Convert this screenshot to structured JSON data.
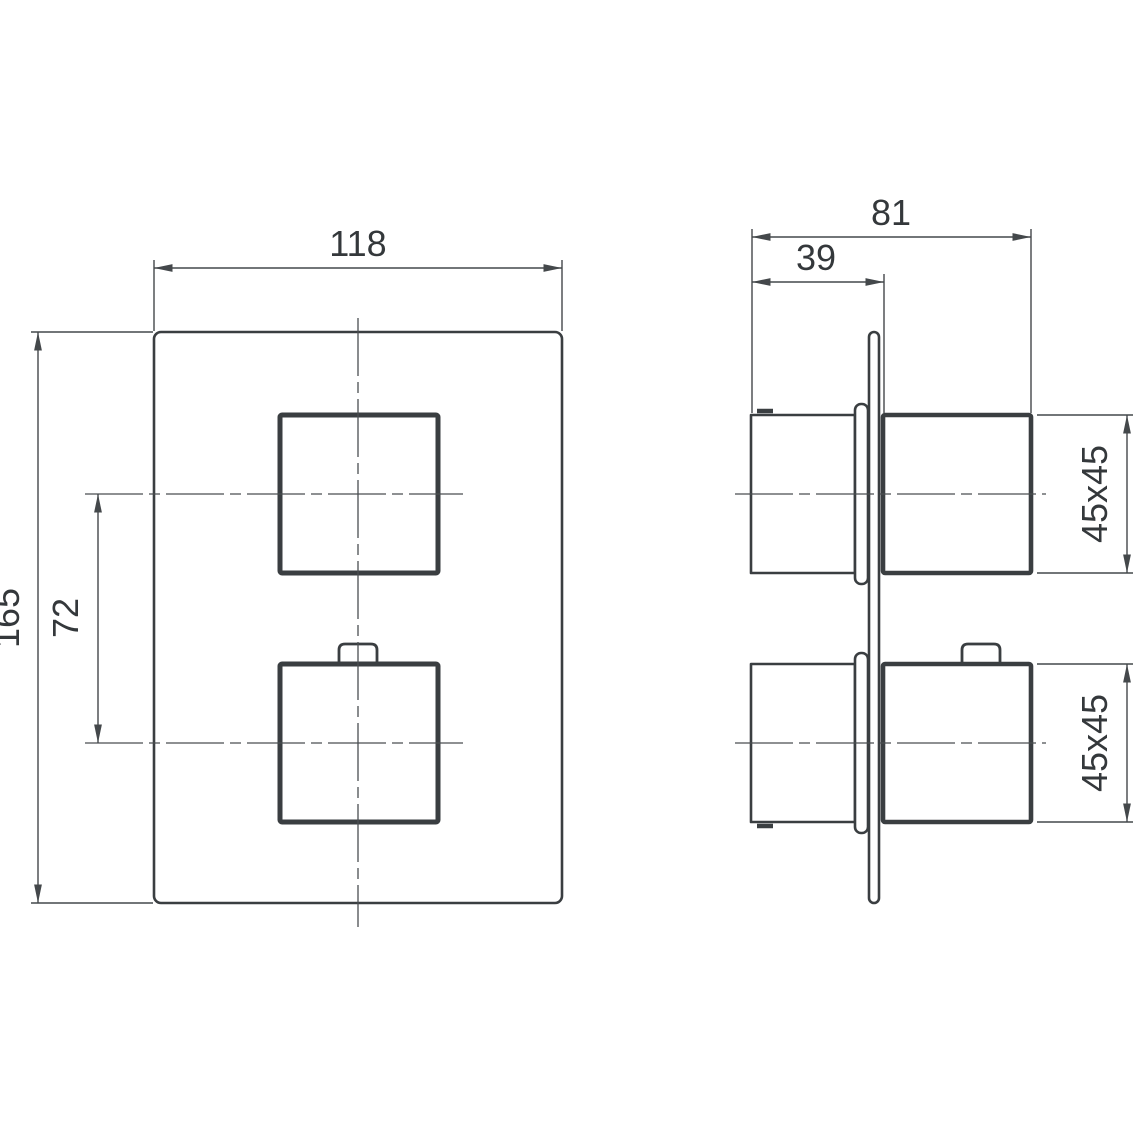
{
  "drawing": {
    "background_color": "#ffffff",
    "line_color": "#3a3e41",
    "text_color": "#34383b",
    "front_view": {
      "width_label": "118",
      "height_label": "165",
      "handle_spacing_label": "72"
    },
    "side_view": {
      "total_depth_label": "81",
      "wall_depth_label": "39",
      "upper_handle_size_label": "45x45",
      "lower_handle_size_label": "45x45"
    }
  }
}
